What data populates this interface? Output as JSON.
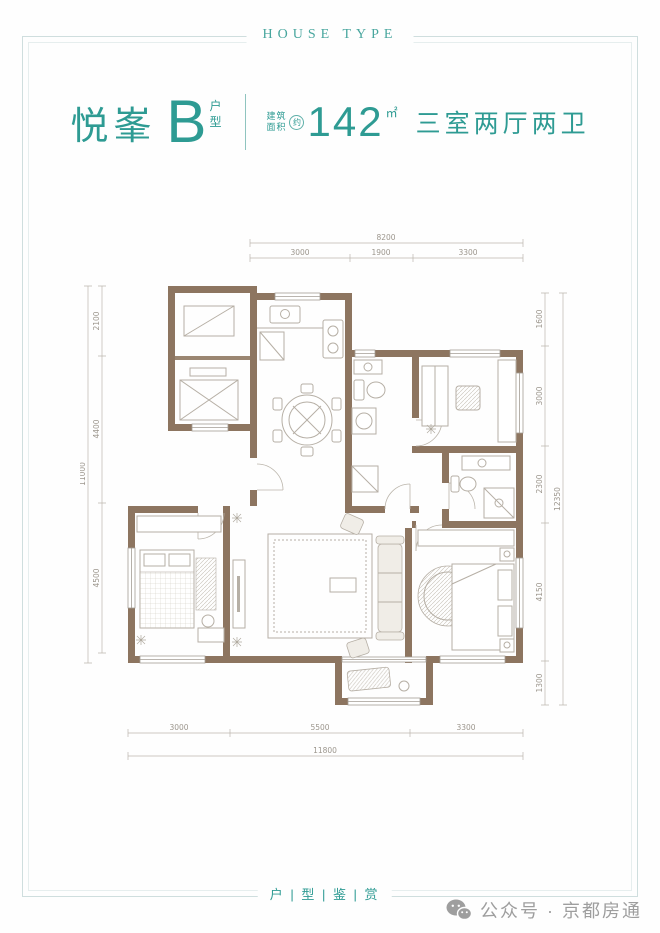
{
  "banner": {
    "title": "HOUSE TYPE"
  },
  "header": {
    "project_name": "悦峯",
    "unit_letter": "B",
    "unit_suffix_top": "户",
    "unit_suffix_bottom": "型",
    "area_label_top": "建筑",
    "area_label_bottom": "面积",
    "area_approx": "约",
    "area_value": "142",
    "area_unit": "㎡",
    "layout_desc": "三室两厅两卫"
  },
  "floorplan": {
    "dims": {
      "top": {
        "overall": "8200",
        "segments": [
          "3000",
          "1900",
          "3300"
        ]
      },
      "bottom": {
        "overall": "11800",
        "segments": [
          "3000",
          "5500",
          "3300"
        ]
      },
      "left": {
        "overall": "11000",
        "segments": [
          "2100",
          "4400",
          "4500"
        ]
      },
      "right": {
        "overall": "12350",
        "segments": [
          "1600",
          "3000",
          "2300",
          "4150",
          "1300"
        ]
      }
    },
    "colors": {
      "wall": "#8d7560",
      "furniture": "#b6afa5",
      "dimension": "#9c968d"
    }
  },
  "footer": {
    "tagline": "户 | 型 | 鉴 | 赏",
    "account": "公众号 · 京都房通"
  },
  "colors": {
    "accent": "#2e9b93",
    "frame": "#cfdede",
    "footer_text": "#9e9e9e"
  }
}
